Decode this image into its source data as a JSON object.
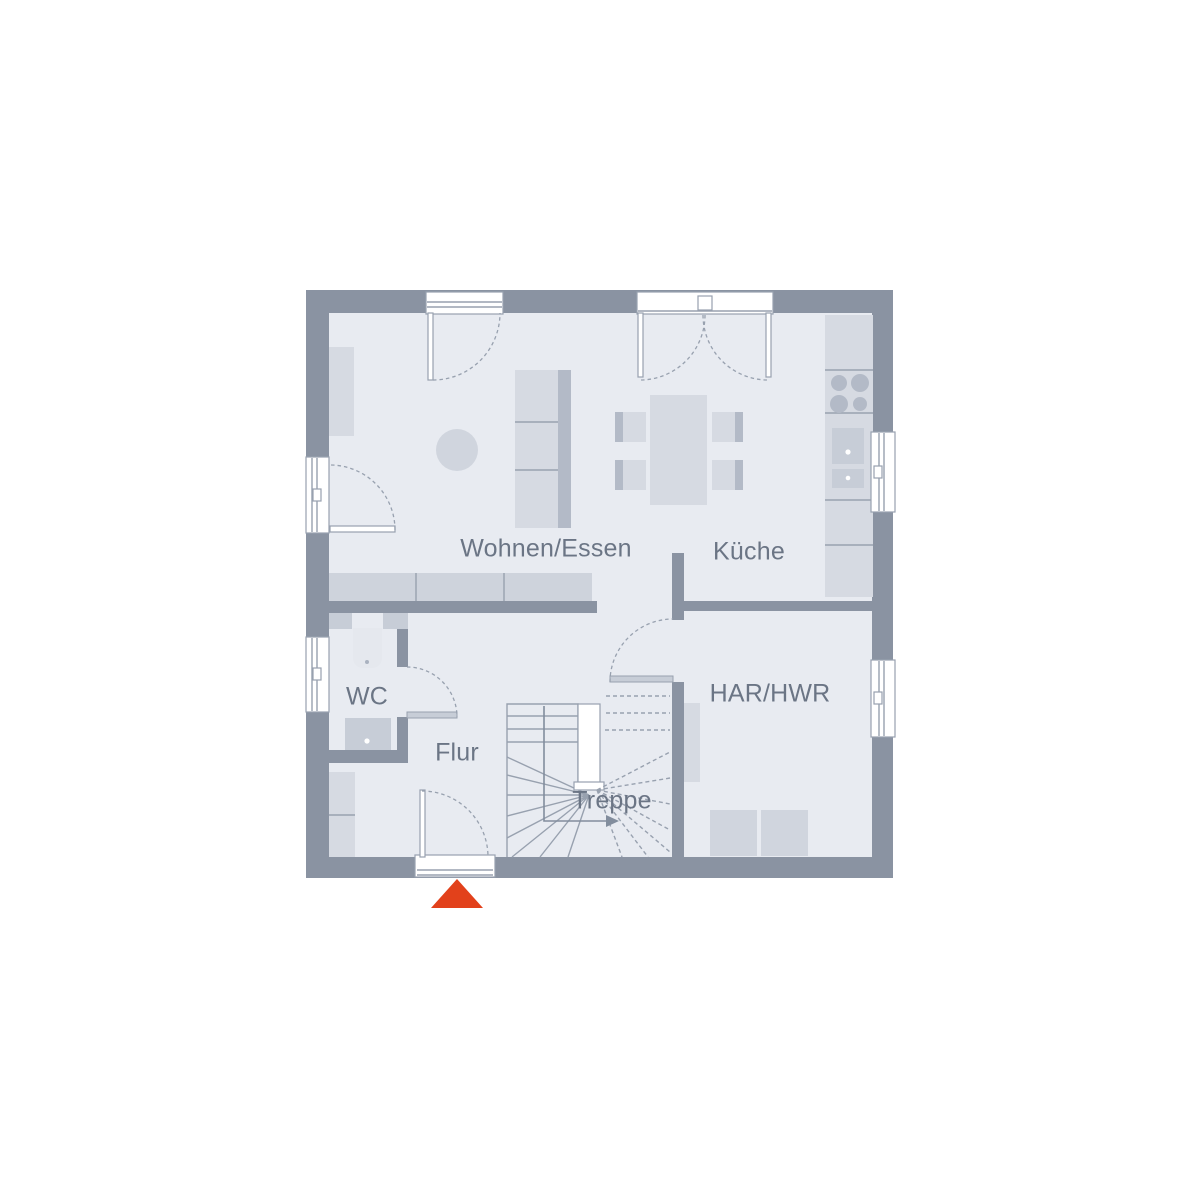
{
  "plan": {
    "rooms": {
      "living_dining": {
        "label": "Wohnen/Essen"
      },
      "kitchen": {
        "label": "Küche"
      },
      "wc": {
        "label": "WC"
      },
      "hall": {
        "label": "Flur"
      },
      "stairs": {
        "label": "Treppe"
      },
      "utility": {
        "label": "HAR/HWR"
      }
    },
    "entrance_marker": {
      "icon": "entrance-triangle",
      "color": "#e2411b"
    }
  },
  "colors": {
    "wall": "#8a93a2",
    "floor": "#e8ebf1",
    "furn-light": "#d6dae2",
    "furn-med": "#c7cdd7",
    "furn-dark": "#b3bac7",
    "line": "#98a1af",
    "label": "#6b7585",
    "accent": "#e2411b",
    "bg": "#ffffff"
  }
}
